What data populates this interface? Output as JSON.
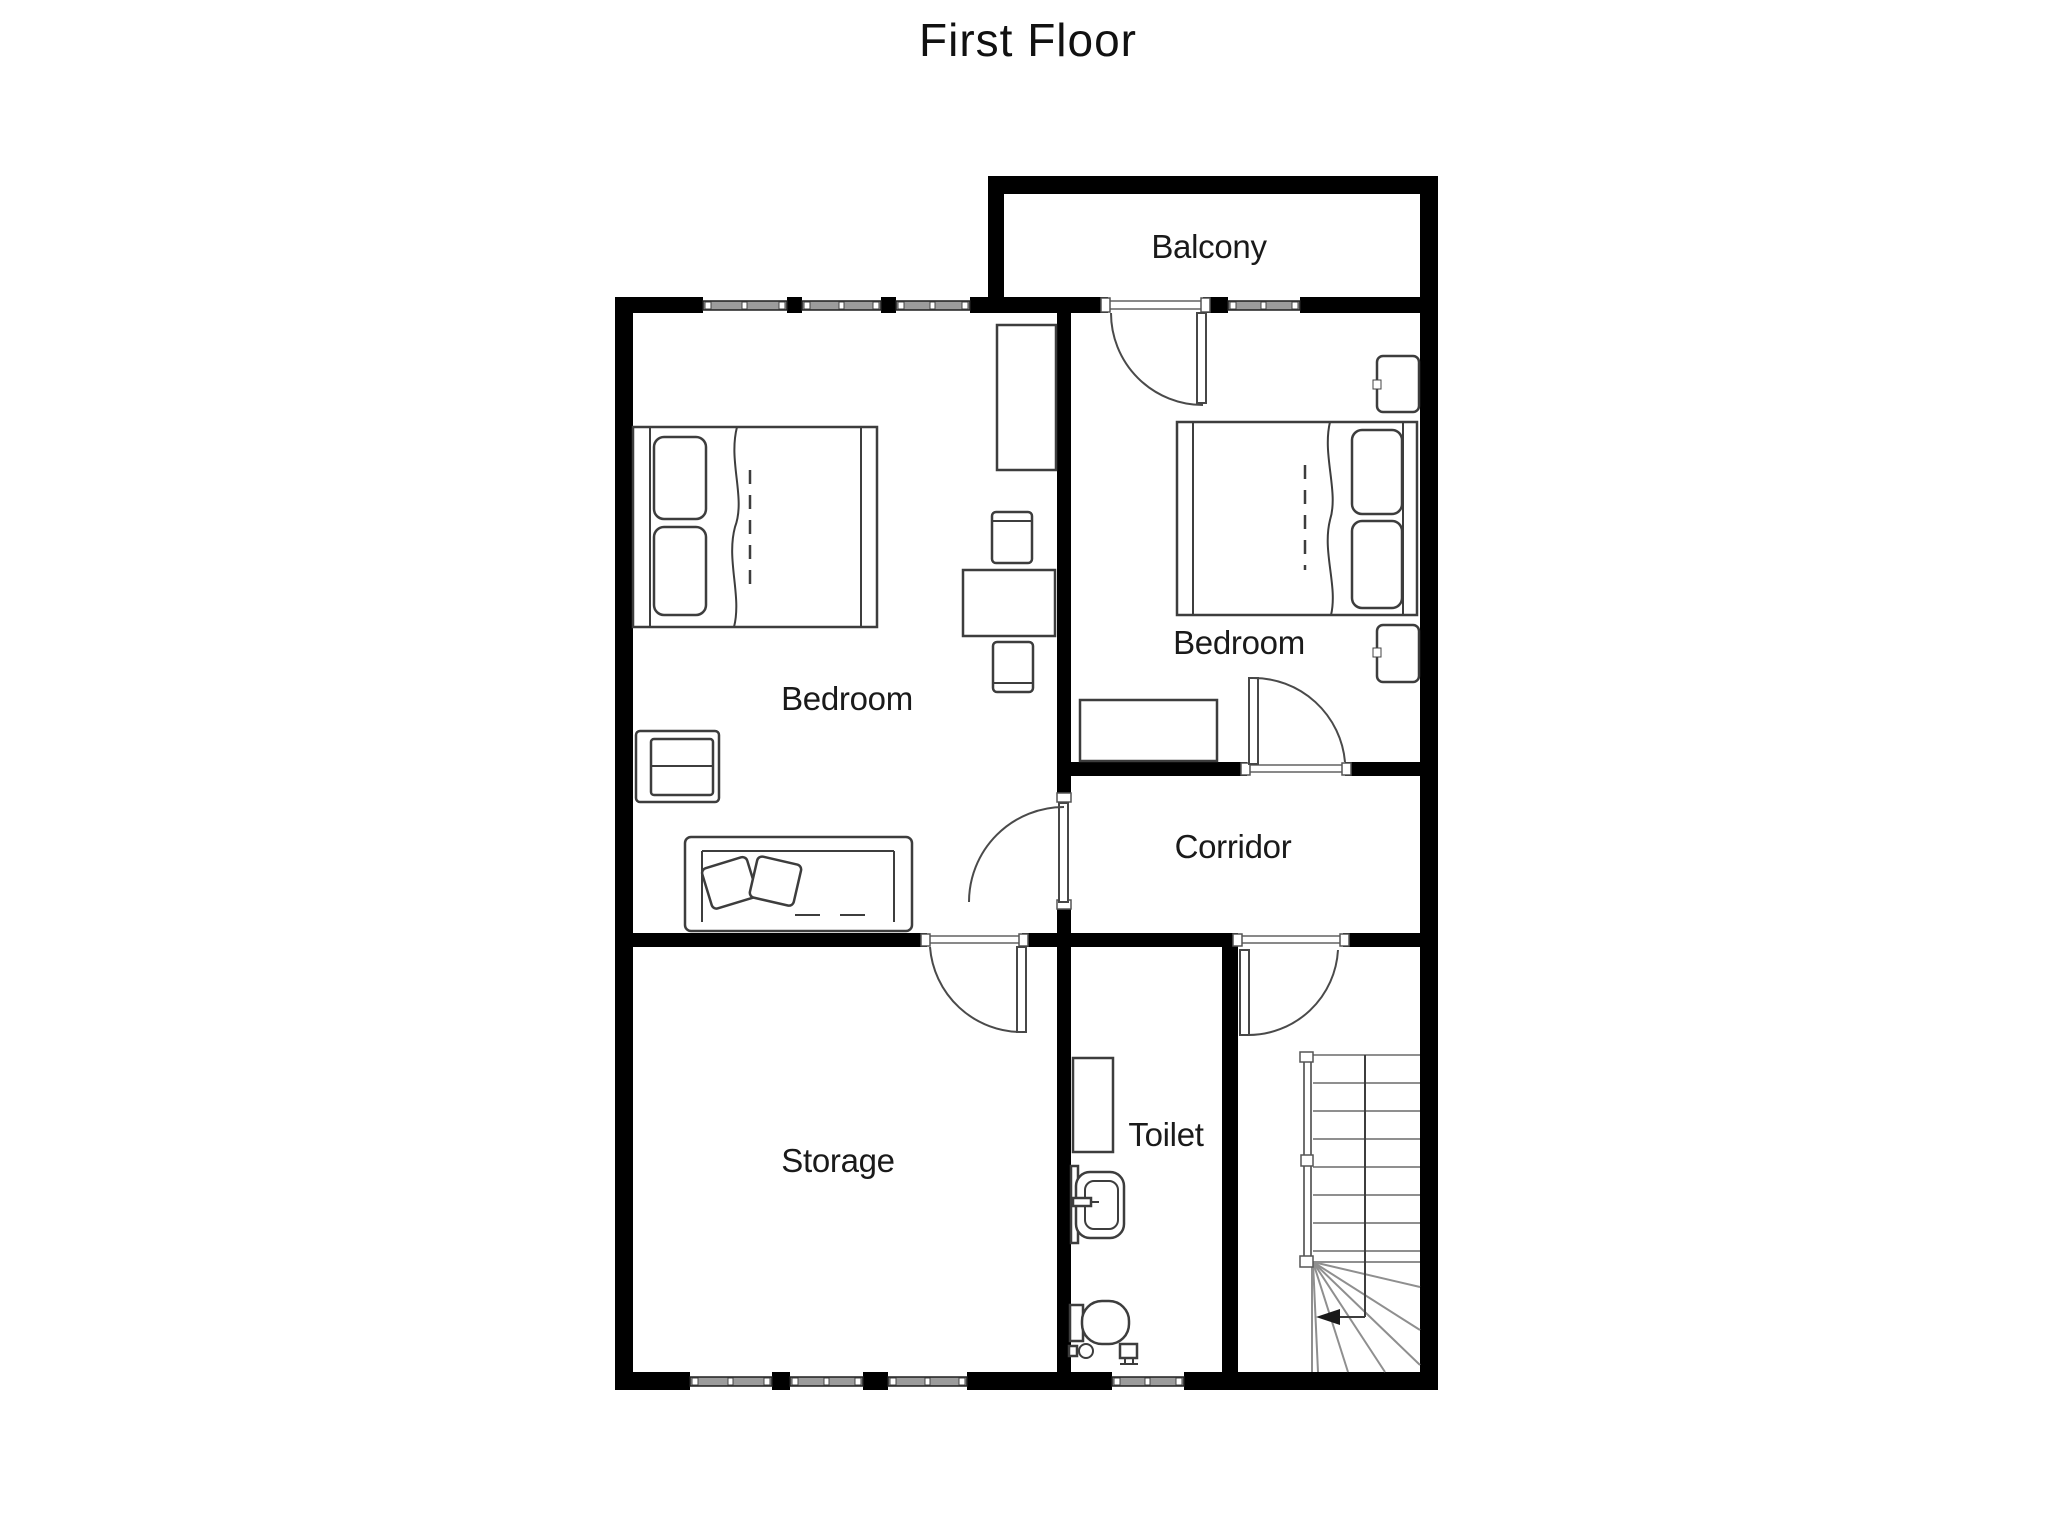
{
  "page_title": "First Floor",
  "rooms": {
    "balcony": {
      "label": "Balcony"
    },
    "bedroom_left": {
      "label": "Bedroom"
    },
    "bedroom_right": {
      "label": "Bedroom"
    },
    "corridor": {
      "label": "Corridor"
    },
    "storage": {
      "label": "Storage"
    },
    "toilet": {
      "label": "Toilet"
    }
  },
  "fixtures": [
    "double-bed-icon",
    "double-bed-icon",
    "wardrobe-icon",
    "desk-icon",
    "chair-icon",
    "chair-icon",
    "armchair-icon",
    "sofa-icon",
    "dresser-icon",
    "nightstand-icon",
    "nightstand-icon",
    "bathroom-cabinet-icon",
    "sink-icon",
    "toilet-bowl-icon",
    "toilet-paper-icon",
    "floor-drain-icon",
    "staircase-icon",
    "door-icon",
    "window-icon"
  ],
  "colors": {
    "background": "#ffffff",
    "wall": "#000000",
    "window_band": "#9c9c9c",
    "door_arc": "#4a4a4a",
    "furniture_stroke": "#3d3d3d",
    "stair_line": "#8f8f8f",
    "text": "#1a1a1a"
  }
}
